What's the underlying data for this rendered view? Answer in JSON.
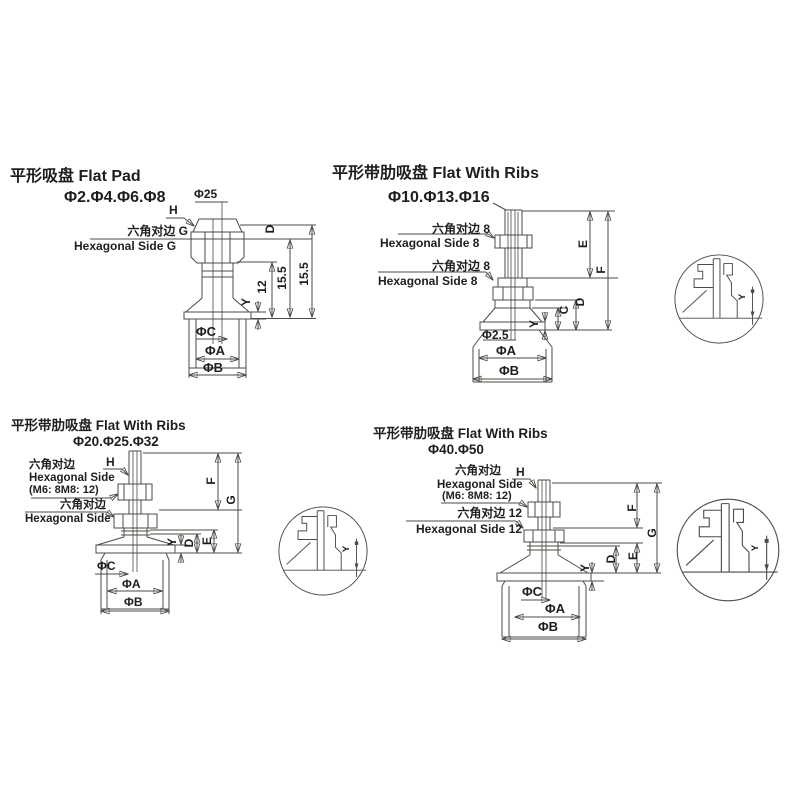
{
  "sheet": {
    "line_color": "#4e4b46",
    "text_color": "#1e1e1e",
    "background": "#ffffff"
  },
  "drawings": [
    {
      "id": "flat-pad",
      "title": "平形吸盘 Flat Pad",
      "sizes": "Φ2.Φ4.Φ6.Φ8",
      "labels": {
        "stem_dia": "Φ25",
        "h": "H",
        "hex_cn": "六角对边 G",
        "hex_en": "Hexagonal Side G",
        "dim_d": "D",
        "dim_12": "12",
        "dim_155_inner": "15.5",
        "dim_155_outer": "15.5",
        "dim_y": "Y",
        "dia_c": "ΦC",
        "dia_a": "ΦA",
        "dia_b": "ΦB"
      }
    },
    {
      "id": "flat-with-ribs-small",
      "title": "平形带肋吸盘 Flat With Ribs",
      "sizes": "Φ10.Φ13.Φ16",
      "labels": {
        "hex1_cn": "六角对边 8",
        "hex1_en": "Hexagonal Side 8",
        "hex2_cn": "六角对边 8",
        "hex2_en": "Hexagonal Side 8",
        "dim_e": "E",
        "dim_f": "F",
        "dim_d": "D",
        "dim_c": "C",
        "dim_y": "Y",
        "dia_hole": "Φ2.5",
        "dia_a": "ΦA",
        "dia_b": "ΦB"
      }
    },
    {
      "id": "flat-with-ribs-medium",
      "title": "平形带肋吸盘 Flat With Ribs",
      "sizes": "Φ20.Φ25.Φ32",
      "labels": {
        "h": "H",
        "hex1_cn": "六角对边",
        "hex1_en": "Hexagonal Side",
        "hex1_note": "(M6: 8M8: 12)",
        "hex2_cn": "六角对边",
        "hex2_en": "Hexagonal Side",
        "dim_f": "F",
        "dim_g": "G",
        "dim_e": "E",
        "dim_d": "D",
        "dim_y": "Y",
        "dia_c": "ΦC",
        "dia_a": "ΦA",
        "dia_b": "ΦB"
      }
    },
    {
      "id": "flat-with-ribs-large",
      "title": "平形带肋吸盘 Flat With Ribs",
      "sizes": "Φ40.Φ50",
      "labels": {
        "h": "H",
        "hex1_cn": "六角对边",
        "hex1_en": "Hexagonal Side",
        "hex1_note": "(M6: 8M8: 12)",
        "hex2_cn": "六角对边 12",
        "hex2_en": "Hexagonal Side 12",
        "dim_f": "F",
        "dim_g": "G",
        "dim_e": "E",
        "dim_d": "D",
        "dim_y": "Y",
        "dia_c": "ΦC",
        "dia_a": "ΦA",
        "dia_b": "ΦB"
      }
    }
  ],
  "details": [
    {
      "label": "Y"
    },
    {
      "label": "Y"
    },
    {
      "label": "Y"
    }
  ]
}
